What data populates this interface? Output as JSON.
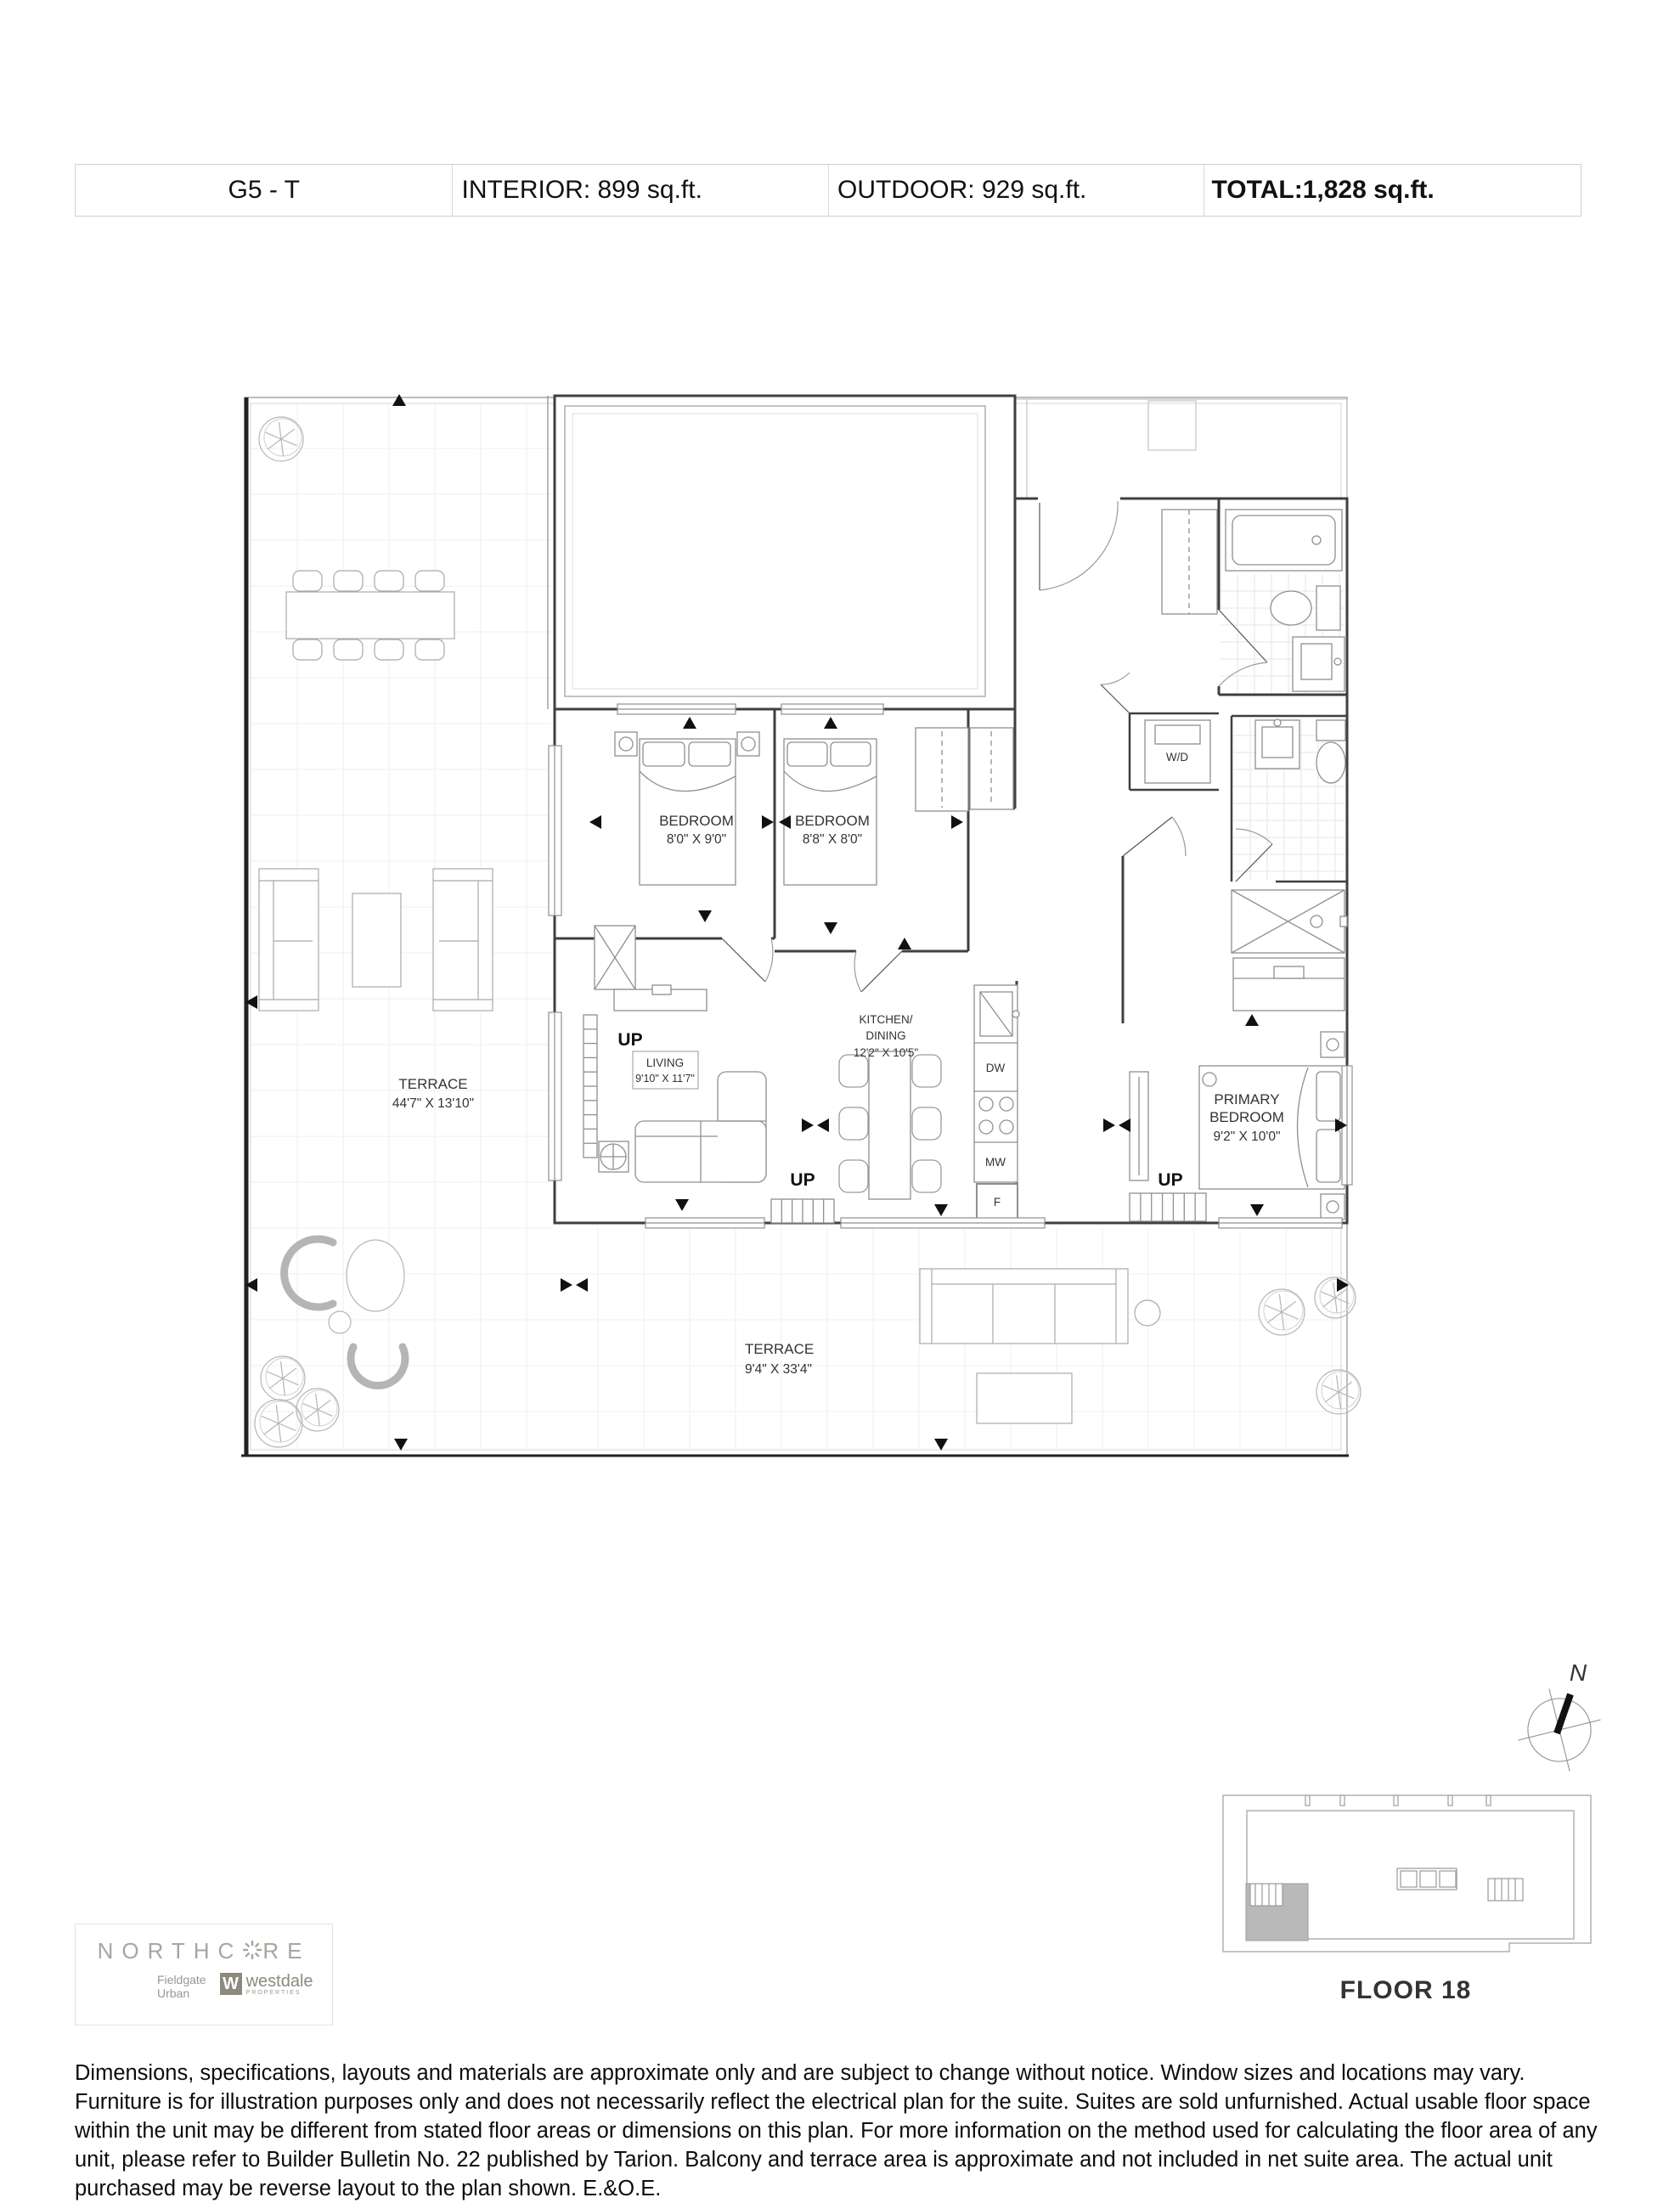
{
  "header": {
    "unit": "G5 - T",
    "interior": "INTERIOR: 899 sq.ft.",
    "outdoor": "OUTDOOR: 929 sq.ft.",
    "total_label": "TOTAL:",
    "total_value": "1,828 sq.ft."
  },
  "plan": {
    "terrace_left": {
      "name": "TERRACE",
      "dims": "44'7\" X 13'10\""
    },
    "terrace_bottom": {
      "name": "TERRACE",
      "dims": "9'4\" X 33'4\""
    },
    "bedroom1": {
      "name": "BEDROOM",
      "dims": "8'0\" X 9'0\""
    },
    "bedroom2": {
      "name": "BEDROOM",
      "dims": "8'8\" X 8'0\""
    },
    "kitchen": {
      "line1": "KITCHEN/",
      "line2": "DINING",
      "dims": "12'2\" X 10'5\""
    },
    "living": {
      "name": "LIVING",
      "dims": "9'10\" X 11'7\""
    },
    "primary": {
      "line1": "PRIMARY",
      "line2": "BEDROOM",
      "dims": "9'2\" X 10'0\""
    },
    "labels": {
      "up": "UP",
      "wd": "W/D",
      "dw": "DW",
      "mw": "MW",
      "f": "F"
    }
  },
  "keyplan": {
    "floor": "FLOOR 18",
    "north": "N"
  },
  "branding": {
    "logo_pre": "NORTHC",
    "logo_post": "RE",
    "partner1_line1": "Fieldgate",
    "partner1_line2": "Urban",
    "partner2": "westdale",
    "partner2_sub": "PROPERTIES",
    "partner2_mark": "W"
  },
  "disclaimer": "Dimensions, specifications, layouts and materials are approximate only and are subject to change without notice. Window sizes and locations may vary. Furniture is for illustration purposes only and does not necessarily reflect the electrical plan for the suite. Suites are sold unfurnished. Actual usable floor space within the unit may be different from stated floor areas or dimensions on this plan. For more information on the method used for calculating the floor area of any unit, please refer to Builder Bulletin No. 22 published by Tarion. Balcony and terrace area is approximate and not included in net suite area. The actual unit purchased may be reverse layout to the plan shown. E.&O.E.",
  "colors": {
    "wall": "#3f3f3f",
    "furniture": "#9a9a9a",
    "brand_gray": "#a9a59e",
    "keyplan_unit_fill": "#b9b9b9"
  }
}
